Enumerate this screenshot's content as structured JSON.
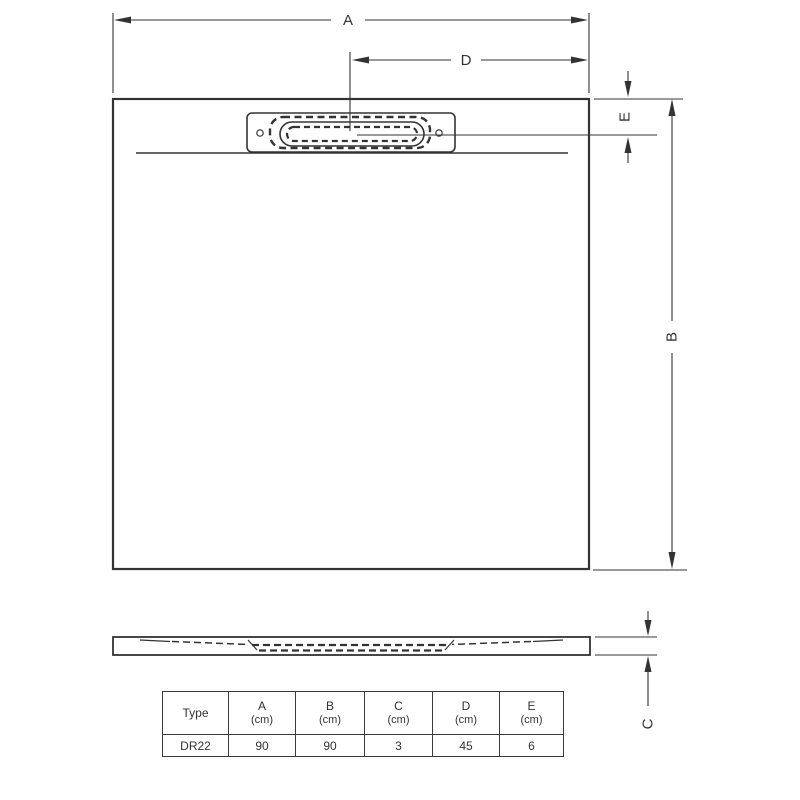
{
  "colors": {
    "ink": "#333333",
    "background": "#ffffff"
  },
  "diagram": {
    "description": "shower-tray-dimension-drawing",
    "dim_labels": {
      "a": "A",
      "b": "B",
      "c": "C",
      "d": "D",
      "e": "E"
    }
  },
  "table": {
    "columns": [
      {
        "label": "Type",
        "unit": ""
      },
      {
        "label": "A",
        "unit": "(cm)"
      },
      {
        "label": "B",
        "unit": "(cm)"
      },
      {
        "label": "C",
        "unit": "(cm)"
      },
      {
        "label": "D",
        "unit": "(cm)"
      },
      {
        "label": "E",
        "unit": "(cm)"
      }
    ],
    "rows": [
      {
        "type": "DR22",
        "a": "90",
        "b": "90",
        "c": "3",
        "d": "45",
        "e": "6"
      }
    ]
  }
}
